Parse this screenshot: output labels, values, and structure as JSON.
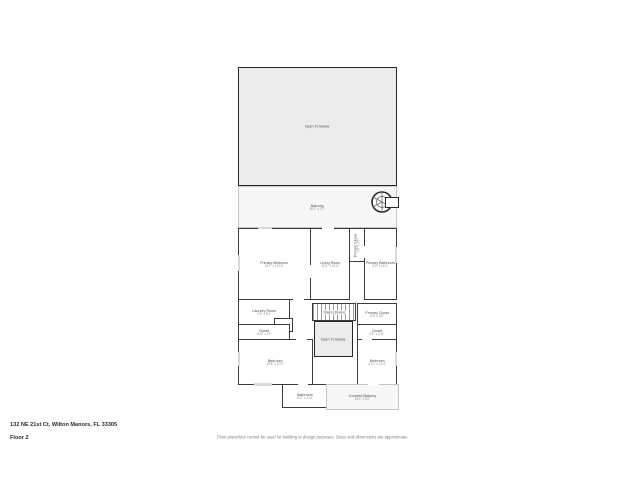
{
  "page": {
    "address": "132 NE 21st Ct, Wilton Manors, FL 33305",
    "floor_label": "Floor 2",
    "disclaimer": "Floor plans/tour cannot be used for building or design purposes. Sizes and dimensions are approximate."
  },
  "colors": {
    "wall": "#3b3b3b",
    "shaded_fill": "#ececec",
    "balcony_fill": "#f7f7f7",
    "label_text": "#4d4d4d",
    "dims_text": "#909090"
  },
  "rooms": {
    "open_below_top": {
      "name": "Open To Below"
    },
    "balcony": {
      "name": "Balcony",
      "dims": "36'1\" x 7'2\""
    },
    "primary_bedroom": {
      "name": "Primary Bedroom",
      "dims": "16'4\" x 13'10\""
    },
    "living_room": {
      "name": "Living Room",
      "dims": "8'11\" x 16'4\""
    },
    "primary_closet_upper": {
      "name": "Primary Closet",
      "dims": "7'8\" x 3'5\""
    },
    "primary_bathroom": {
      "name": "Primary Bathroom",
      "dims": "8'5\" x 16'4\""
    },
    "laundry_room": {
      "name": "Laundry Room",
      "dims": "5'6\" x 5'5\""
    },
    "closet_small": {
      "name": "Closet"
    },
    "closet_left": {
      "name": "Closet",
      "dims": "11'6\" x 3'2\""
    },
    "stairs": {
      "name": "Stairs (Down)"
    },
    "open_below_center": {
      "name": "Open To Below"
    },
    "primary_closet": {
      "name": "Primary Closet",
      "dims": "8'8\" x 4'8\""
    },
    "closet_right": {
      "name": "Closet",
      "dims": "8'8\" x 2'11\""
    },
    "bedroom_left": {
      "name": "Bedroom",
      "dims": "16'8\" x 10'2\""
    },
    "bedroom_right": {
      "name": "Bedroom",
      "dims": "8'10\" x 13'4\""
    },
    "bathroom": {
      "name": "Bathroom",
      "dims": "10'2\" x 4'11\""
    },
    "covered_balcony": {
      "name": "Covered Balcony",
      "dims": "16'4\" x 5'2\""
    }
  },
  "icons": {
    "spiral_staircase": "spiral staircase"
  }
}
